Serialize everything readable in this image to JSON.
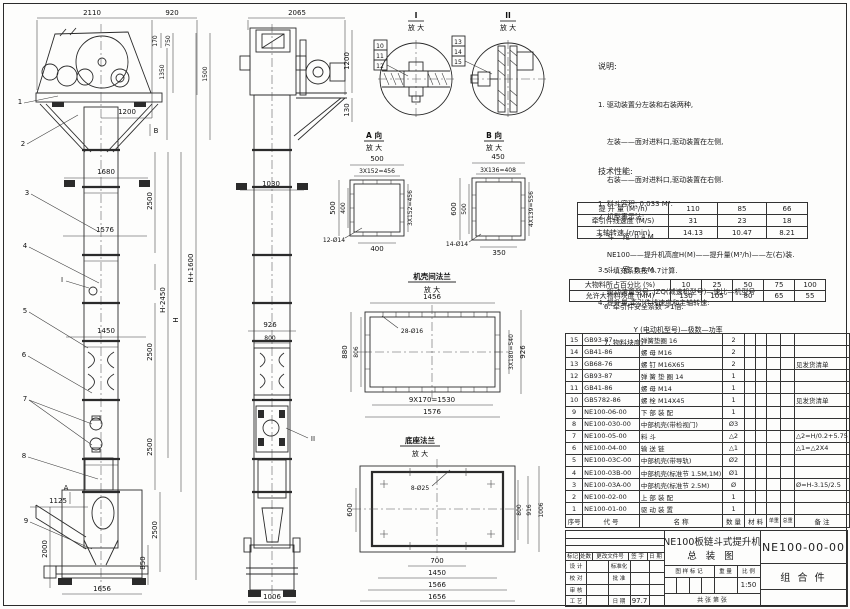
{
  "front_view": {
    "leaders": [
      "1",
      "2",
      "3",
      "4",
      "5",
      "6",
      "7",
      "8",
      "9"
    ],
    "marker_b": "B",
    "marker_a": "A",
    "marker_i": "I",
    "dims": {
      "w2110": "2110",
      "w920": "920",
      "h170": "170",
      "h750": "750",
      "h1350": "1350",
      "h1500": "1500",
      "w1200": "1200",
      "w1680": "1680",
      "v2500a": "2500",
      "w1576": "1576",
      "hplus": "H+1600",
      "h": "H",
      "hminus": "H-2450",
      "w1450": "1450",
      "v2500b": "2500",
      "v2500c": "2500",
      "v2500d": "2500",
      "w1125": "1125",
      "v2000": "2000",
      "v850": "850",
      "w1656": "1656"
    }
  },
  "side_view": {
    "marker_ii": "II",
    "dims": {
      "w2065": "2065",
      "v1200": "1200",
      "v130": "130",
      "w1030": "1030",
      "w926": "926",
      "w800": "800",
      "w1006": "1006"
    }
  },
  "detail_i": {
    "title": "I",
    "sub": "放 大",
    "tags": [
      "10",
      "11",
      "12"
    ]
  },
  "detail_ii": {
    "title": "II",
    "sub": "放 大",
    "tags": [
      "13",
      "14",
      "15"
    ]
  },
  "view_a": {
    "title": "A 向",
    "sub": "放 大",
    "dims": {
      "t500": "500",
      "t456": "3X152=456",
      "l500": "500",
      "l400": "400",
      "r456": "3X152=456",
      "b400": "400",
      "holes": "12-Ø14"
    }
  },
  "view_b": {
    "title": "B 向",
    "sub": "放 大",
    "dims": {
      "t450": "450",
      "t408": "3X136=408",
      "l600": "600",
      "l500": "500",
      "r556": "4X139=556",
      "b350": "350",
      "holes": "14-Ø14"
    }
  },
  "flange_view": {
    "title": "机壳间法兰",
    "sub": "放 大",
    "dims": {
      "t1456": "1456",
      "holes": "28-Ø16",
      "l880": "880",
      "l806": "806",
      "r540": "3X180=540",
      "r926": "926",
      "b1530": "9X170=1530",
      "b1576": "1576"
    }
  },
  "base_view": {
    "title": "底座法兰",
    "sub": "放 大",
    "dims": {
      "holes": "8-Ø25",
      "l600": "600",
      "r800": "800",
      "r916": "916",
      "r1006": "1006",
      "b700": "700",
      "b1450": "1450",
      "b1566": "1566",
      "b1656": "1656"
    }
  },
  "notes": {
    "heading": "说明:",
    "lines": [
      "1. 驱动装置分左装和右装两种,",
      "    左装——面对进料口,驱动装置在左侧,",
      "    右装——面对进料口,驱动装置在右侧.",
      "2. 机型表示法:",
      "    NE100——提升机高度H(M)——提升量(M³/h)——左(右)装.",
      "    驱动装置型号: JZQ(减速机型号)—速比—机型号",
      "                Y (电动机型号)—极数—功率"
    ]
  },
  "perf": {
    "heading": "技术性能:",
    "lines_before": [
      "1. 料斗容积: 0.033 M³.",
      "2. 斗    距: 0.4 M.",
      "3. 斗    宽: 0.4 M.",
      "4. 提升量,牵引件线速度和主轴转速:"
    ],
    "lines_after": [
      "5. 填充系数按 0.7计算.",
      "6. 牵引件安全系数 >1倍.",
      "7. 物料块度:"
    ]
  },
  "chart_data": {
    "type": "table",
    "capacity": {
      "rows": [
        {
          "label": "提 升 量  (M³/h)",
          "values": [
            "110",
            "85",
            "66"
          ]
        },
        {
          "label": "牵引件线速度 (M/S)",
          "values": [
            "31",
            "23",
            "18"
          ]
        },
        {
          "label": "主轴转速 (r/min)",
          "values": [
            "14.13",
            "10.47",
            "8.21"
          ]
        }
      ]
    },
    "lump": {
      "rows": [
        {
          "label": "大物料所占百分比 (%)",
          "values": [
            "10",
            "25",
            "50",
            "75",
            "100"
          ]
        },
        {
          "label": "允许大物料块度 (MM)",
          "values": [
            "130",
            "105",
            "80",
            "65",
            "55"
          ]
        }
      ]
    }
  },
  "bom": {
    "headers": {
      "seq": "序号",
      "code": "代    号",
      "name": "名        称",
      "qty": "数 量",
      "mat": "材    料",
      "unit": "单重",
      "total": "总重",
      "remark": "备    注"
    },
    "rows": [
      {
        "seq": "15",
        "code": "GB93-87",
        "name": "弹簧垫圈    16",
        "qty": "2",
        "remark": ""
      },
      {
        "seq": "14",
        "code": "GB41-86",
        "name": "螺  母    M16",
        "qty": "2",
        "remark": ""
      },
      {
        "seq": "13",
        "code": "GB68-76",
        "name": "螺  钉    M16X65",
        "qty": "2",
        "remark": "见发货清单"
      },
      {
        "seq": "12",
        "code": "GB93-87",
        "name": "弹 簧 垫 圈    14",
        "qty": "1",
        "remark": ""
      },
      {
        "seq": "11",
        "code": "GB41-86",
        "name": "螺  母    M14",
        "qty": "1",
        "remark": ""
      },
      {
        "seq": "10",
        "code": "GB5782-86",
        "name": "螺  栓    M14X45",
        "qty": "1",
        "remark": "见发货清单"
      },
      {
        "seq": "9",
        "code": "NE100-06-00",
        "name": "下 部 装 配",
        "qty": "1",
        "remark": ""
      },
      {
        "seq": "8",
        "code": "NE100-030-00",
        "name": "中部机壳(带检视门)",
        "qty": "Ø3",
        "remark": ""
      },
      {
        "seq": "7",
        "code": "NE100-05-00",
        "name": "料  斗",
        "qty": "△2",
        "remark": "△2=H/0.2+5.75"
      },
      {
        "seq": "6",
        "code": "NE100-04-00",
        "name": "输 送 链",
        "qty": "△1",
        "remark": "△1=△2X4"
      },
      {
        "seq": "5",
        "code": "NE100-03C-00",
        "name": "中部机壳(带导轨)",
        "qty": "Ø2",
        "remark": ""
      },
      {
        "seq": "4",
        "code": "NE100-03B-00",
        "name": "中部机壳(标准节 1.5M,1M)",
        "qty": "Ø1",
        "remark": ""
      },
      {
        "seq": "3",
        "code": "NE100-03A-00",
        "name": "中部机壳(标准节 2.5M)",
        "qty": "Ø",
        "remark": "Ø=H-3.15/2.5"
      },
      {
        "seq": "2",
        "code": "NE100-02-00",
        "name": "上 部 装 配",
        "qty": "1",
        "remark": ""
      },
      {
        "seq": "1",
        "code": "NE100-01-00",
        "name": "驱 动 装 置",
        "qty": "1",
        "remark": ""
      }
    ]
  },
  "title_block": {
    "rev_header": [
      "标记",
      "处数",
      "更改文件号",
      "签 字",
      "日 期"
    ],
    "r1a": "设 计",
    "r1b": "标准化",
    "r2a": "校 对",
    "r2b": "批 准",
    "r3a": "审 核",
    "r4a": "工 艺",
    "r4b": "日 期",
    "r4c": "97.7",
    "drawing_title_1": "NE100板链斗式提升机",
    "drawing_title_2": "总  装  图",
    "stamp_h1": "图 样 标 记",
    "stamp_h2": "重 量",
    "stamp_h3": "比 例",
    "scale": "1:50",
    "sheet_line": "共  张  第  张",
    "drawing_no": "NE100-00-00",
    "part_type": "组  合  件"
  }
}
